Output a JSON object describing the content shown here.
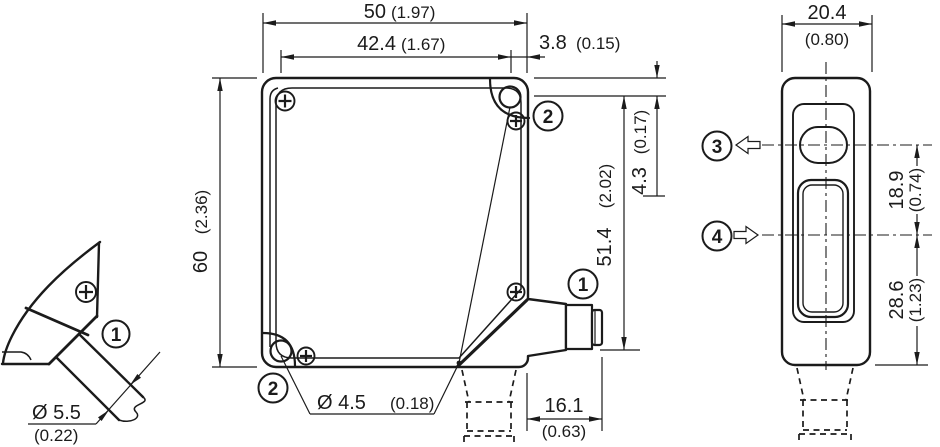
{
  "style": {
    "line_color": "#1b1b1b",
    "background": "#ffffff"
  },
  "callouts": {
    "cable_gland": "1",
    "connector": "1",
    "mounting_hole_top": "2",
    "mounting_hole_bottom": "2",
    "sender_axis": "3",
    "receiver_axis": "4"
  },
  "front_view": {
    "width_mm": "50",
    "width_in": "(1.97)",
    "hole_offset_mm": "42.4",
    "hole_offset_in": "(1.67)",
    "edge_offset_mm": "3.8",
    "edge_offset_in": "(0.15)",
    "height_mm": "60",
    "height_in": "(2.36)",
    "hole_top_mm": "4.3",
    "hole_top_in": "(0.17)",
    "connector_axis_mm": "51.4",
    "connector_axis_in": "(2.02)",
    "hole_diameter_mm": "Ø 4.5",
    "hole_diameter_in": "(0.18)",
    "connector_length_mm": "16.1",
    "connector_length_in": "(0.63)"
  },
  "side_view": {
    "depth_mm": "20.4",
    "depth_in": "(0.80)",
    "optical_axis_gap_mm": "18.9",
    "optical_axis_gap_in": "(0.74)",
    "receiver_axis_bottom_mm": "28.6",
    "receiver_axis_bottom_in": "(1.23)"
  },
  "cable_view": {
    "cable_diameter_mm": "Ø 5.5",
    "cable_diameter_in": "(0.22)"
  }
}
